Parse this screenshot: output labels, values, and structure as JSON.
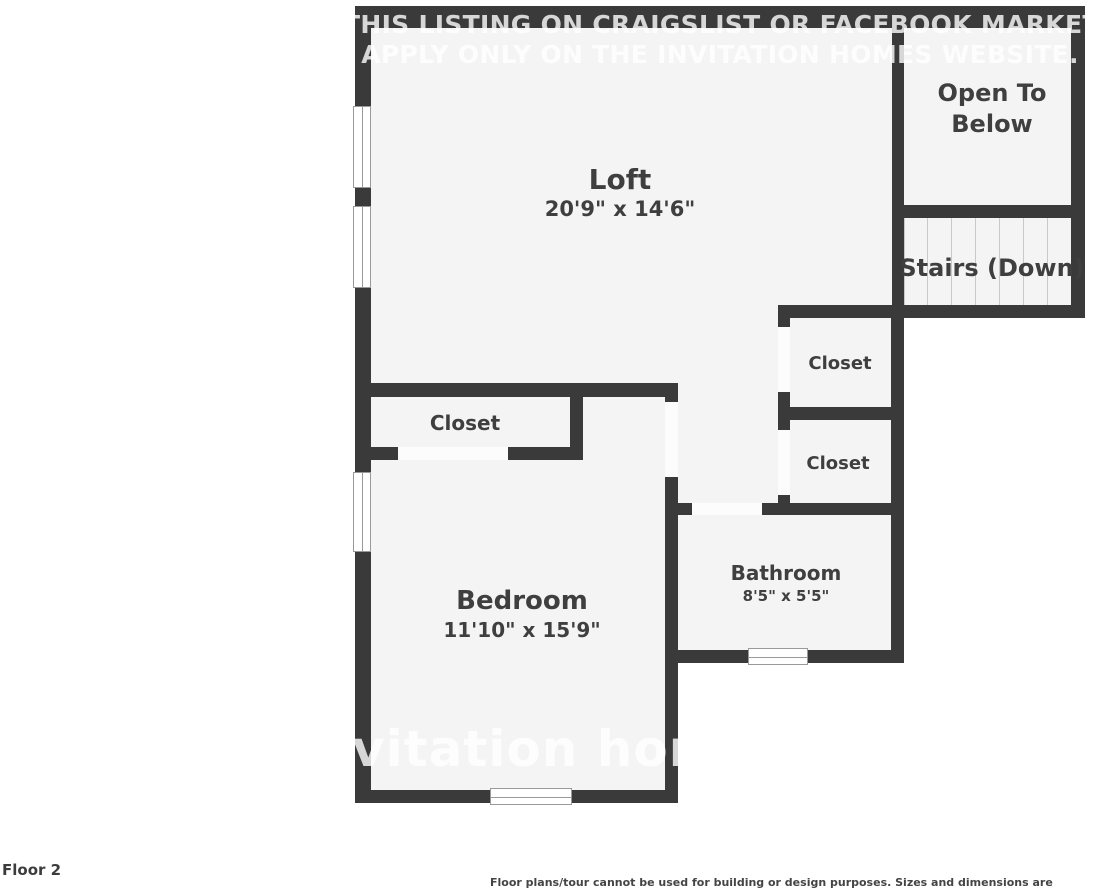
{
  "footer": {
    "floor_label": "Floor 2",
    "disclaimer": "Floor plans/tour cannot be used for building or design purposes. Sizes and dimensions are approximate."
  },
  "watermark": {
    "line1": "THIS LISTING ON CRAIGSLIST OR FACEBOOK MARKETPLACE,",
    "line2": "APPLY ONLY ON THE INVITATION HOMES WEBSITE.",
    "brand": "vitation homes"
  },
  "rooms": {
    "loft": {
      "label": "Loft",
      "dims": "20'9\" x 14'6\""
    },
    "open_to_below": {
      "label": "Open To Below"
    },
    "stairs": {
      "label": "Stairs (Down)"
    },
    "bedroom_closet": {
      "label": "Closet"
    },
    "closet_upper": {
      "label": "Closet"
    },
    "closet_lower": {
      "label": "Closet"
    },
    "bathroom": {
      "label": "Bathroom",
      "dims": "8'5\" x 5'5\""
    },
    "bedroom": {
      "label": "Bedroom",
      "dims": "11'10\" x 15'9\""
    }
  },
  "colors": {
    "wall": "#3a3a3a",
    "floor": "#f4f4f4",
    "door_gap": "#fcfcfc",
    "background": "#ffffff",
    "stair_tread": "#c9c9c9",
    "window_line": "#999999",
    "label_text": "#3f3f3f",
    "watermark": "rgba(255,255,255,0.8)",
    "footer_text": "#3c3c3c"
  }
}
